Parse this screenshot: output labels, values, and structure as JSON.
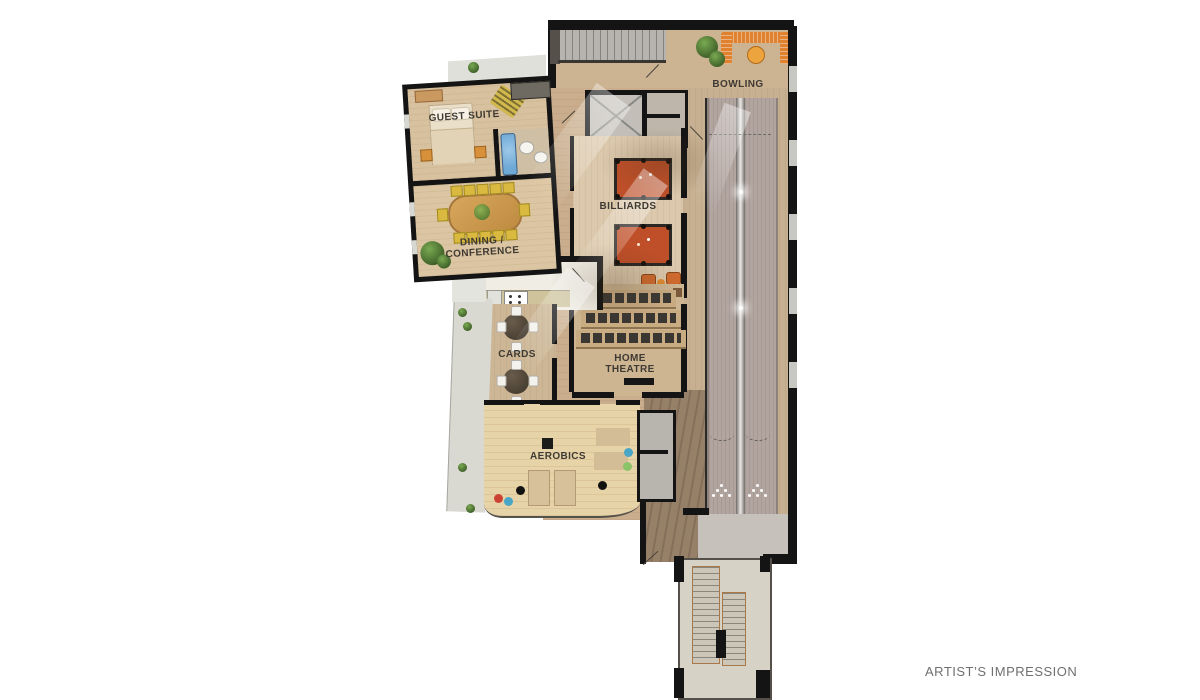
{
  "caption": "ARTIST’S IMPRESSION",
  "floorplan": {
    "title": "clubhouse-amenity-floor-plan",
    "rooms": {
      "guest_suite": {
        "label": "GUEST SUITE"
      },
      "dining_conference": {
        "line1": "DINING /",
        "line2": "CONFERENCE"
      },
      "cards": {
        "label": "CARDS"
      },
      "aerobics": {
        "label": "AEROBICS"
      },
      "billiards": {
        "label": "BILLIARDS"
      },
      "home_theatre": {
        "line1": "HOME",
        "line2": "THEATRE"
      },
      "bowling": {
        "label": "BOWLING"
      }
    },
    "features": [
      "staircase",
      "elevator",
      "bed",
      "bathtub",
      "toilet",
      "sink",
      "wardrobe",
      "dresser",
      "rug",
      "dining-table",
      "dining-chairs",
      "potted-plants",
      "kitchen-counter",
      "stove",
      "fridge",
      "card-tables",
      "balcony",
      "billiard-tables",
      "lounge-chairs",
      "home-theatre-seating",
      "cinema-screen",
      "exercise-mats",
      "exercise-balls",
      "bowling-lanes",
      "ball-return",
      "bowling-pins",
      "banquette-seating",
      "cafe-table",
      "switchback-stairs",
      "terrace"
    ],
    "colors": {
      "background": "#ffffff",
      "wall": "#141414",
      "wood_light": "#e7d3a8",
      "wood_mid": "#ccb392",
      "wood_dark": "#968067",
      "lane_gray": "#b2a5a0",
      "concrete": "#c6c2bb",
      "terrace": "#dfdfd9",
      "accent_orange": "#e0812f",
      "billiard_felt": "#bf4f29",
      "tub_blue": "#6fa9d6",
      "plant_green": "#5d8c3d",
      "label_text": "#3e3a33",
      "caption_text": "#6f6f6f"
    }
  }
}
